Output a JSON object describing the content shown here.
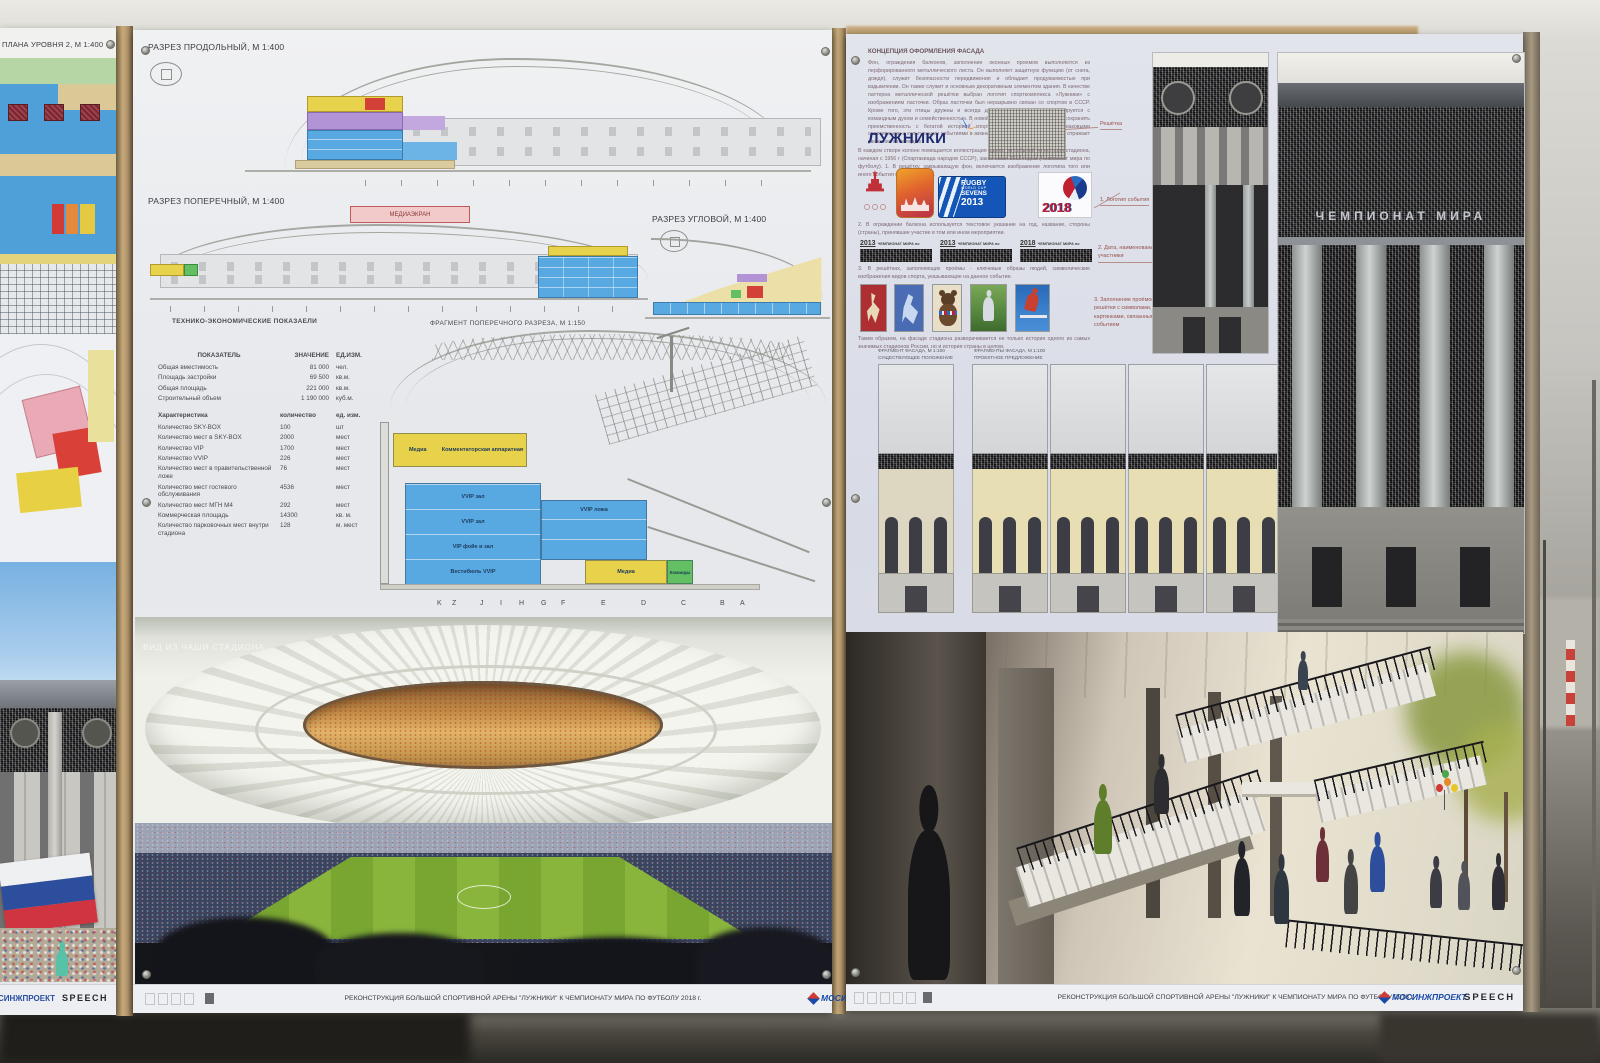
{
  "left_board": {
    "header": "ПЛАНА УРОВНЯ 2, М 1:400",
    "footer_brand1": "СИНЖПРОЕКТ",
    "footer_brand2": "SPEECH"
  },
  "middle_board": {
    "titles": {
      "longitudinal": "РАЗРЕЗ ПРОДОЛЬНЫЙ, М 1:400",
      "transverse": "РАЗРЕЗ ПОПЕРЕЧНЫЙ, М 1:400",
      "corner": "РАЗРЕЗ УГЛОВОЙ, М 1:400",
      "tech": "ТЕХНИКО-ЭКОНОМИЧЕСКИЕ ПОКАЗАЕЛИ",
      "fragment": "ФРАГМЕНТ ПОПЕРЕЧНОГО РАЗРЕЗА, М 1:150",
      "media_screen": "МЕДИАЭКРАН",
      "render_caption": "ВИД ИЗ ЧАШИ СТАДИОНА"
    },
    "tech_table": {
      "headers": [
        "ПОКАЗАТЕЛЬ",
        "ЗНАЧЕНИЕ",
        "ЕД.ИЗМ."
      ],
      "rows": [
        [
          "Общая вместимость",
          "81 000",
          "чел."
        ],
        [
          "Площадь застройки",
          "69 500",
          "кв.м."
        ],
        [
          "Общая площадь",
          "221 000",
          "кв.м."
        ],
        [
          "Строительный объем",
          "1 190 000",
          "куб.м."
        ]
      ]
    },
    "char_table": {
      "headers": [
        "Характеристика",
        "количество",
        "ед. изм."
      ],
      "rows": [
        [
          "Количество SKY-BOX",
          "100",
          "шт"
        ],
        [
          "Количество мест в SKY-BOX",
          "2000",
          "мест"
        ],
        [
          "Количество VIP",
          "1700",
          "мест"
        ],
        [
          "Количество VVIP",
          "226",
          "мест"
        ],
        [
          "Количество мест в правительственной ложе",
          "76",
          "мест"
        ],
        [
          "Количество мест гостевого обслуживания",
          "4536",
          "мест"
        ],
        [
          "Количество мест МГН М4",
          "292",
          "мест"
        ],
        [
          "Коммерческая площадь",
          "14300",
          "кв. м."
        ],
        [
          "Количество парковочных мест внутри стадиона",
          "128",
          "м. мест"
        ]
      ]
    },
    "fragment_labels": {
      "media_top": "Медиа",
      "commentator": "Комментаторская аппаратная",
      "vvip_hall_1": "VVIP зал",
      "vvip_lodge": "VVIP ложа",
      "vvip_hall_2": "VVIP зал",
      "vip_foyer": "VIP фойе и зал",
      "vvip_vestibule": "Вестибюль VVIP",
      "media_bottom": "Медиа",
      "teams": "Команды"
    },
    "grid_letters": [
      "K",
      "Z",
      "J",
      "I",
      "H",
      "G",
      "F",
      "E",
      "D",
      "C",
      "B",
      "A"
    ],
    "footer": {
      "caption": "РЕКОНСТРУКЦИЯ БОЛЬШОЙ СПОРТИВНОЙ АРЕНЫ \"ЛУЖНИКИ\" К ЧЕМПИОНАТУ МИРА ПО ФУТБОЛУ 2018 г.",
      "brand1": "МОСИНЖПРОЕКТ",
      "brand2": "SPEECH"
    }
  },
  "right_board": {
    "concept": {
      "title": "КОНЦЕПЦИЯ ОФОРМЛЕНИЯ ФАСАДА",
      "para1": "Фон, ограждения балконов, заполнение оконных проемов выполняются из перфорированного металлического листа. Он выполняет защитную функцию (от снега, дождя), служит безопасности передвижения и обладает продуваемостью при вздымлении. Он также служит и основным декоративным элементом здания. В качестве паттерна металлической решётки выбран логотип спорткомплекса «Лужники» с изображением ласточки. Образ ласточки был неразрывно связан со спортом в СССР. Кроме того, эти птицы дружны и всегда держатся стаями, что ассоциируется с командным духом и семейственностью. В новой символике было необходимо сохранить преемственность с богатой историей спорткомплекса, связанной со знаковыми спортивными и культурными событиями в жизни России. Такой образ ласточки отражает уважение к наследию.",
      "luzhniki": "ЛУЖНИКИ",
      "grate_label": "Решётка",
      "para2": "В каждом створе колонн помещается иллюстрация одного из событий из истории стадиона, начиная с 1956 г (Спартакиада народов СССР), заканчивая 2018 годом (Чемпионат мира по футболу). 1. В решётку, закрывающую фон, включается изображение логотипа того или иного события (соревнования).",
      "logo_label": "1. Логотип события",
      "rugby": {
        "l1": "RUGBY",
        "l2": "WORLD CUP",
        "l3": "SEVENS",
        "l4": "2013"
      },
      "fifa": "2018",
      "para3": "2. В ограждении балкона используется текстовое указание на год, название, стороны (страны), принявшие участие в том или ином мероприятии.",
      "year_strips": [
        {
          "year": "2013",
          "text": "ЧЕМПИОНАТ МИРА по"
        },
        {
          "year": "2013",
          "text": "ЧЕМПИОНАТ МИРА по"
        },
        {
          "year": "2018",
          "text": "ЧЕМПИОНАТ МИРА по"
        }
      ],
      "date_label": "2. Дата, наименование, участники",
      "para4": "3. В решётках, заполняющих проёмы - ключевые образы людей, символические изображения видов спорта, указывающие на данное событие.",
      "infill_label": "3. Заполнение проёмов - решётки с символами, картинками, связанными с событием",
      "para5": "Таким образом, на фасаде стадиона разворачивается не только история одного из самых значимых стадионов России, но и история страны в целом."
    },
    "fragments": {
      "existing_t1": "ФРАГМЕНТ ФАСАДА, М 1:100",
      "existing_t2": "СУЩЕСТВУЮЩЕЕ ПОЛОЖЕНИЕ",
      "proposed_t1": "ФРАГМЕНТЫ ФАСАДА, М 1:100",
      "proposed_t2": "ПРОЕКТНОЕ ПРЕДЛОЖЕНИЕ"
    },
    "facade_text": "ЧЕМПИОНАТ МИРА",
    "footer": {
      "caption": "РЕКОНСТРУКЦИЯ БОЛЬШОЙ СПОРТИВНОЙ АРЕНЫ \"ЛУЖНИКИ\" К ЧЕМПИОНАТУ МИРА ПО ФУТБОЛУ 2018 г.",
      "brand1": "МОСИНЖПРОЕКТ",
      "brand2": "SPEECH"
    }
  }
}
